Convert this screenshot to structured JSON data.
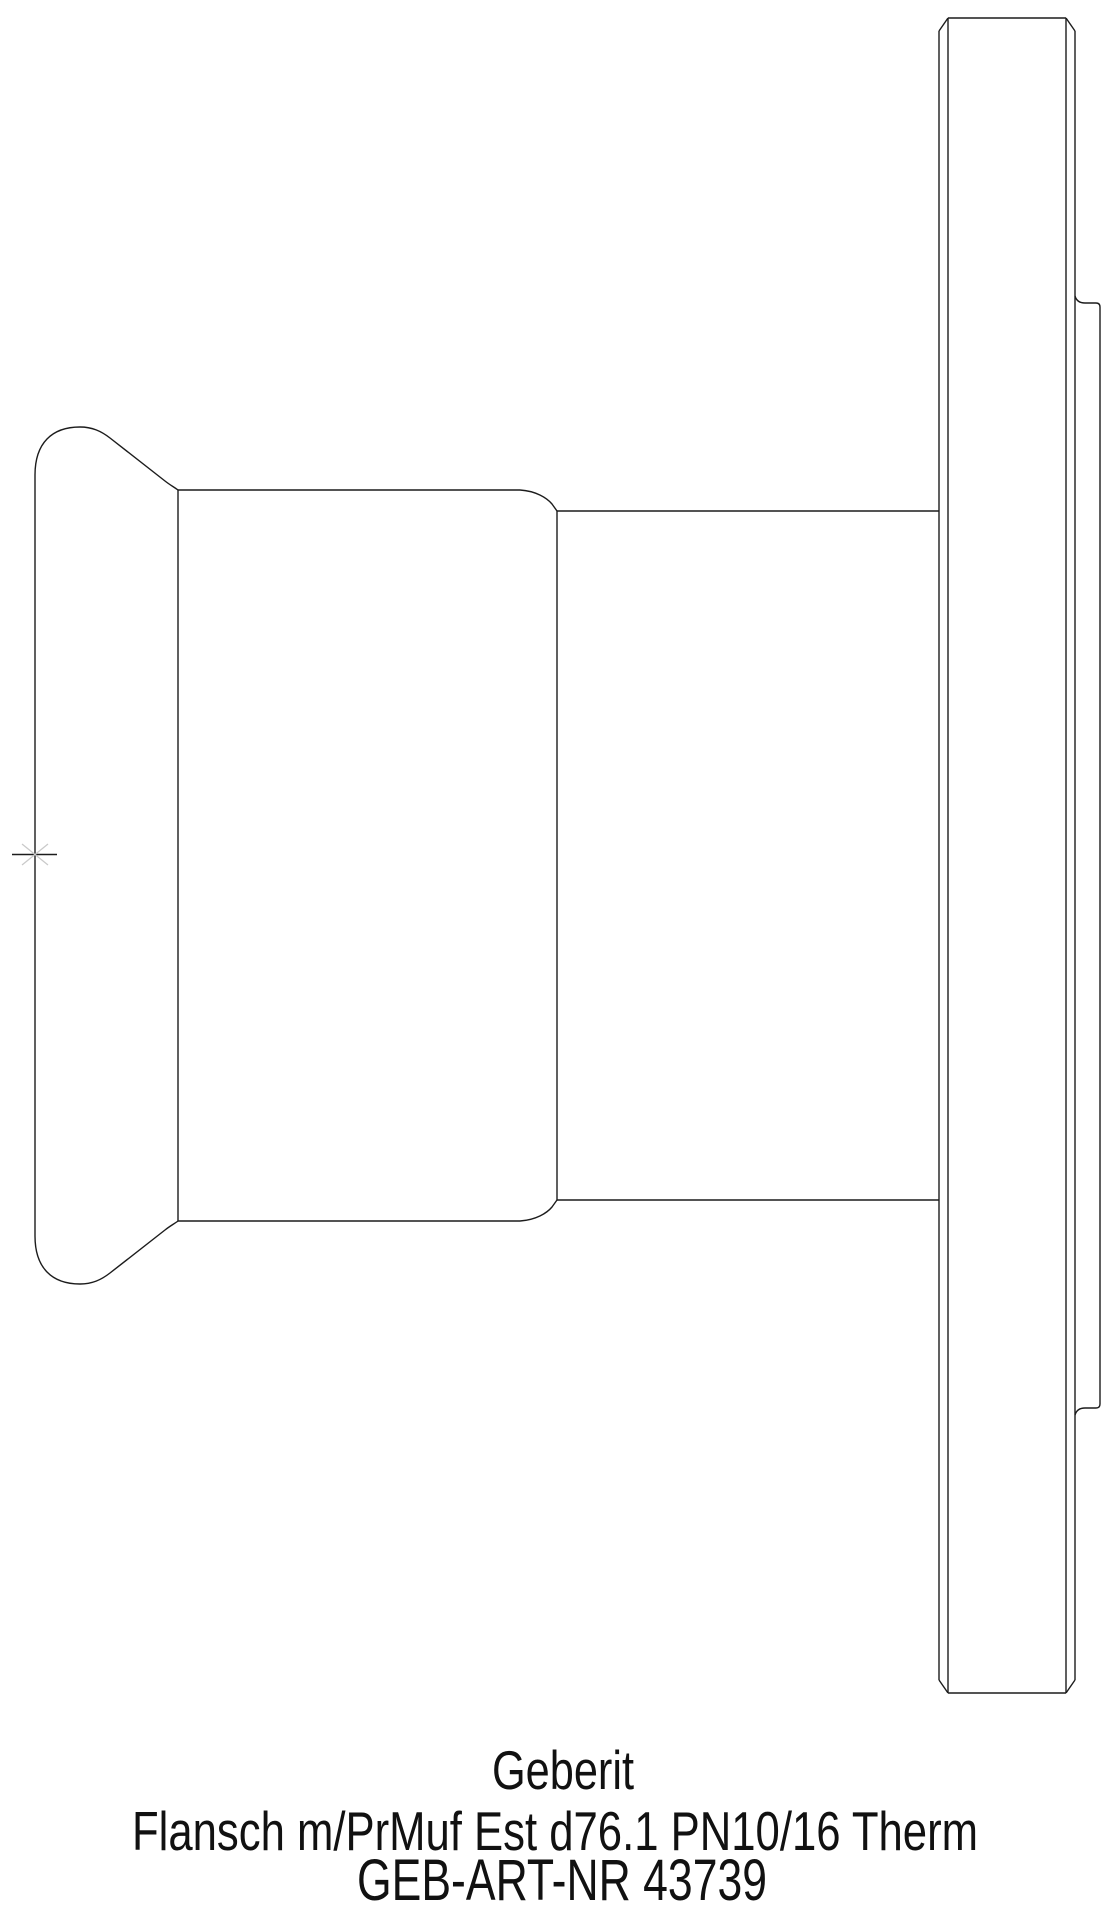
{
  "page": {
    "background": "#ffffff"
  },
  "label_block": {
    "brand": "Geberit",
    "description": "Flansch m/PrMuf Est d76.1 PN10/16 Therm",
    "article_number": "GEB-ART-NR 43739"
  },
  "colors": {
    "line": "#1c1c1c",
    "text_primary": "#111111",
    "text_secondary": "#3d3d3d",
    "center_mark_faint": "#c9c9c9"
  }
}
